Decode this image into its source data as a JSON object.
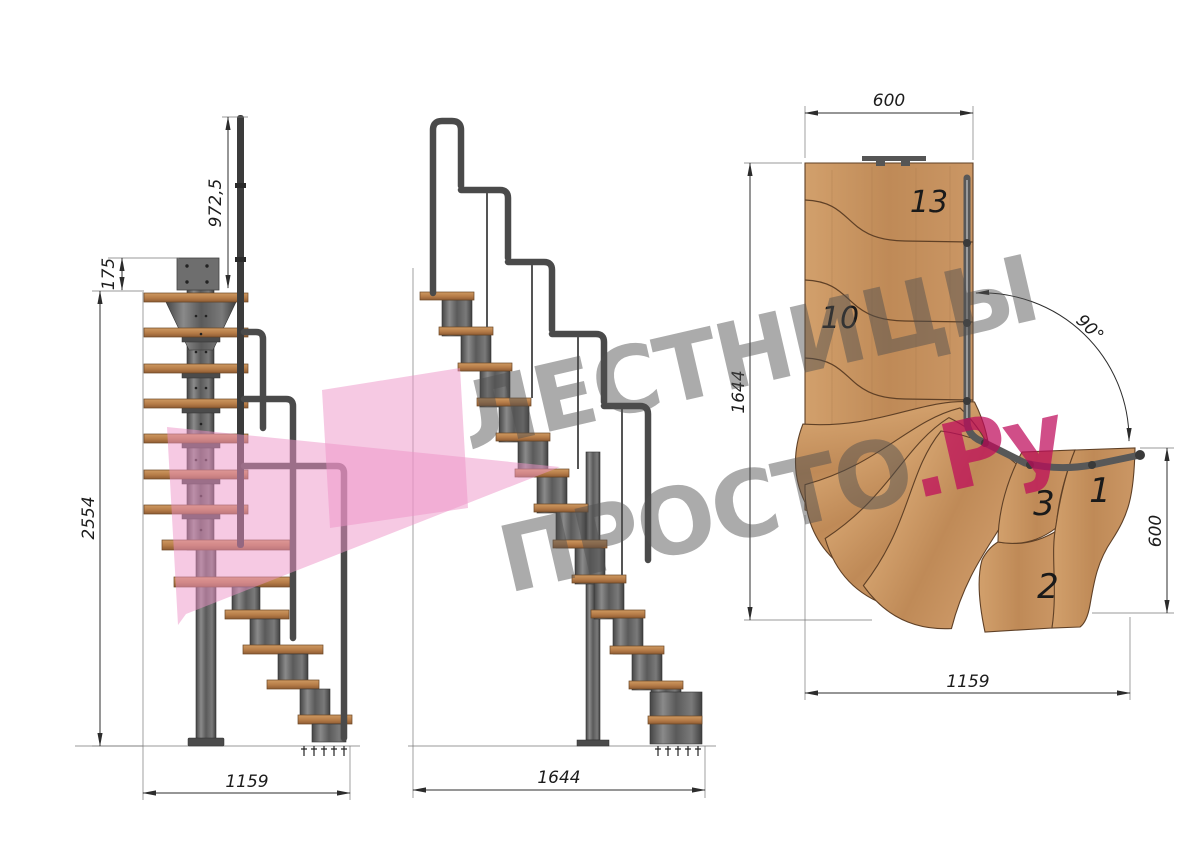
{
  "watermark": {
    "line1": "ЛЕСТНИЦЫ",
    "line2_gray": "ПРОСТО",
    "line2_pink": ".Ру"
  },
  "colors": {
    "logo_pink": "#ee93c8",
    "watermark_gray": "#a9a9a9",
    "watermark_pink": "#d04f88",
    "wood_side": "#b67c48",
    "wood_plan": "#c08a58",
    "metal": "#5a5a5a",
    "dimension_line": "#2c2c2c"
  },
  "front_view": {
    "handrail_height": "972,5",
    "top_rise": "175",
    "total_height": "2554",
    "base_width": "1159"
  },
  "side_view": {
    "total_run": "1644"
  },
  "plan_view": {
    "top_width": "600",
    "left_length": "1644",
    "turn_angle": "90°",
    "right_width": "600",
    "bottom_length": "1159",
    "steps": {
      "s13": "13",
      "s10": "10",
      "s3": "3",
      "s1": "1",
      "s2": "2"
    }
  }
}
